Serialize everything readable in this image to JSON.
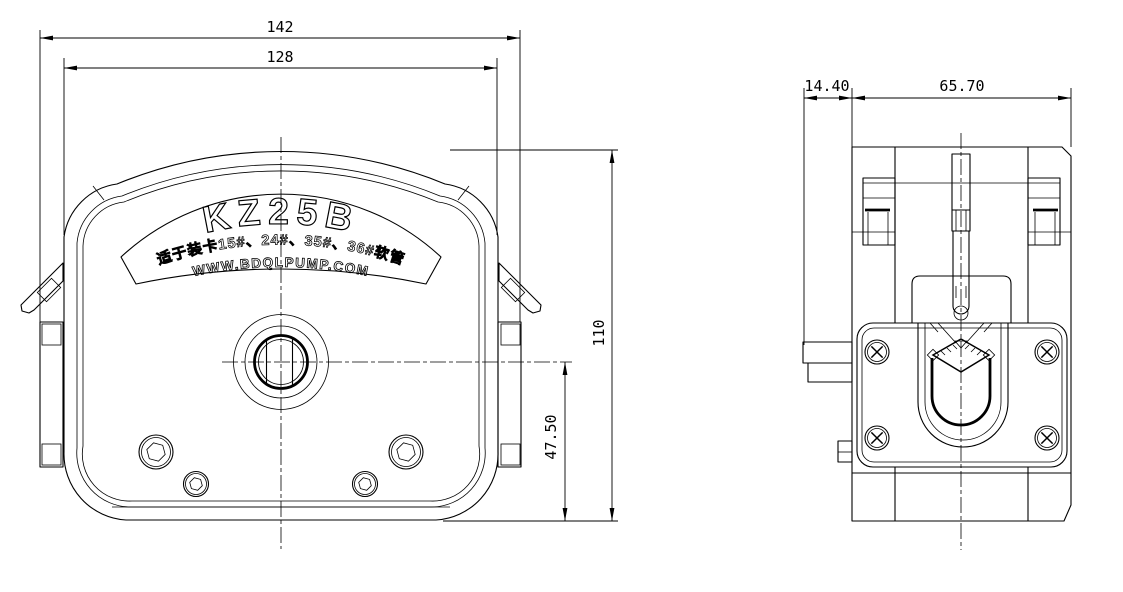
{
  "drawing": {
    "label": {
      "model": "KZ25B",
      "fit_note": "适于装卡15#、24#、35#、36#软管",
      "website": "WWW.BDQLPUMP.COM"
    },
    "dimensions": {
      "front_overall_width": "142",
      "front_body_width": "128",
      "front_height": "110",
      "front_center_to_bottom": "47.50",
      "side_tab_depth": "14.40",
      "side_body_depth": "65.70"
    },
    "colors": {
      "background": "#ffffff",
      "line": "#000000"
    }
  }
}
